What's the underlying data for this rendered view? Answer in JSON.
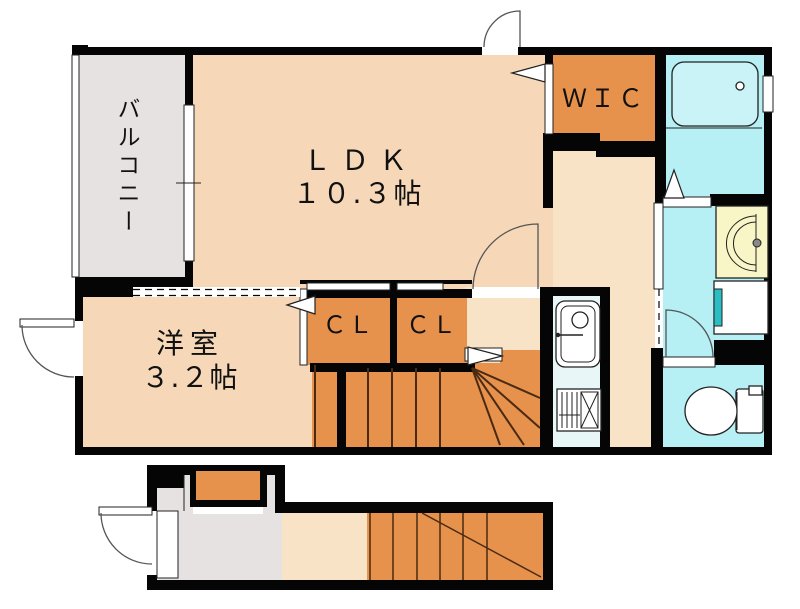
{
  "document": {
    "kind": "japanese-apartment-floor-plan",
    "floors": "2F plan with 1F entrance stair block"
  },
  "colors": {
    "wall": "#050505",
    "room": "#F6D8B8",
    "room_light": "#F9E3C7",
    "orange": "#E6914C",
    "balcony_gray": "#E6E2E1",
    "water_cyan": "#B6EFF4",
    "tub_cyan": "#C9F3F6",
    "kitchen_blue": "#E9F6F8",
    "basin_yellow": "#F8F5C6",
    "wm_teal": "#2ABDC3",
    "line_brown": "#4A2A12",
    "outline": "#222222",
    "arc": "#555555",
    "text": "#111111"
  },
  "labels": {
    "balcony": "バルコニー",
    "ldk_name": "ＬＤＫ",
    "ldk_size": "１０.３帖",
    "wic": "ＷＩＣ",
    "cl1": "ＣＬ",
    "cl2": "ＣＬ",
    "room_name": "洋室",
    "room_size": "３.２帖"
  }
}
